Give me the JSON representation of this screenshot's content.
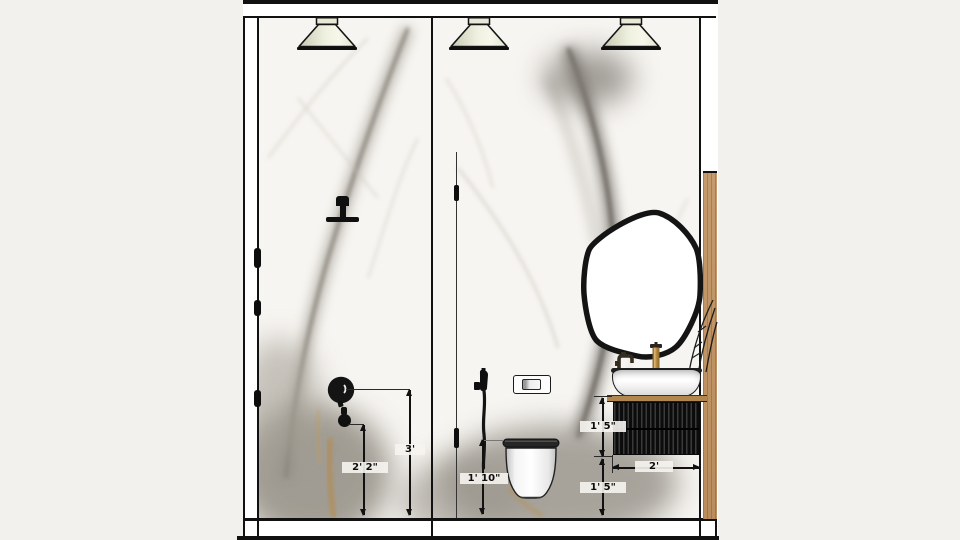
{
  "drawing": {
    "kind": "bathroom interior elevation",
    "dimension_labels": {
      "shower_valve_height": "2' 2\"",
      "shower_head_height": "3'",
      "sprayer_outlet_height": "1' 10\"",
      "vanity_height": "1' 5\"",
      "vanity_width": "2'",
      "vanity_floor_clearance": "1' 5\""
    },
    "fixtures": [
      "pendant-light",
      "pendant-light",
      "pendant-light",
      "rain-shower-head",
      "shower-mixer-valve",
      "hand-shower-outlet",
      "glass-partition",
      "hand-sprayer",
      "flush-plate",
      "wall-hung-toilet",
      "organic-mirror",
      "vessel-sink",
      "black-faucet",
      "brass-faucet",
      "fluted-vanity-cabinet",
      "wood-side-panel"
    ],
    "colors": {
      "background": "#f2f1ee",
      "linework": "#111111",
      "lamp_shade": "#e9ebd9",
      "wood_panel": "#c0956a",
      "countertop": "#b0874f",
      "vanity": "#161616",
      "marble_base": "#f7f5f1",
      "marble_vein": "#807b73"
    }
  }
}
